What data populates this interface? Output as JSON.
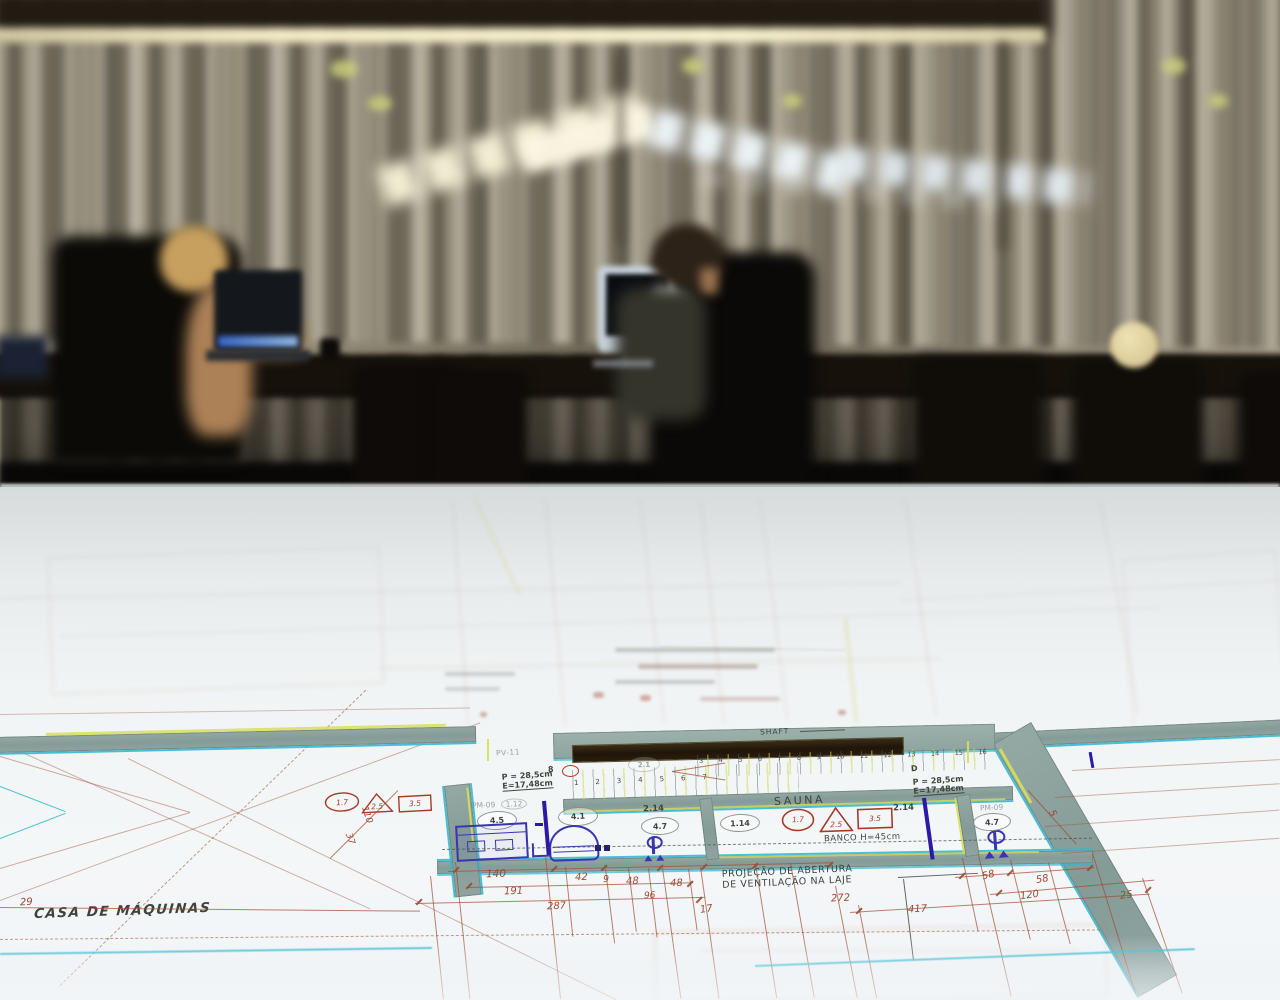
{
  "scene": {
    "type": "blurred-office-photo-background",
    "colors": {
      "wall_stripe_light": "#b7af9c",
      "wall_stripe_dark": "#6e6757",
      "ceiling": "#221b12",
      "light_strip": "#f4ecc6",
      "truss_light_warm": "#f8f2d8",
      "truss_light_cool": "#e6eff6",
      "desk": "#17120c",
      "chair": "#0d0a07",
      "hair_blonde": "#c79f5e",
      "hair_brown": "#2c2217",
      "skin": "#ad8157",
      "tshirt": "#34342b",
      "monitor_frame": "#c9d4de",
      "screen_dark": "#0b0e11",
      "laptop_glow": "#4a78cc",
      "sphere": "#e9daa9"
    }
  },
  "blueprint": {
    "colors": {
      "paper": "#f1f5f6",
      "wall_fill": "#8ba29e",
      "accent_cyan": "#35b8d0",
      "accent_yellow": "#d9de5a",
      "dim_red": "#9a4a31",
      "ink": "#3f463e",
      "fixture_blue": "#3a35b0",
      "symbol_red": "#a83a28",
      "shaft_dark": "#251a0e"
    },
    "labels": {
      "shaft": "SHAFT",
      "sauna": "SAUNA",
      "banco": "BANCO H=45cm",
      "projecao_line1": "PROJEÇÃO DE ABERTURA",
      "projecao_line2": "DE VENTILAÇÃO NA LAJE",
      "casa_maquinas": "CASA DE MÁQUINAS",
      "stair_spec_p": "P = 28,5cm",
      "stair_spec_e": "E=17,48cm",
      "pv11": "PV-11",
      "pm09_left": "PM-09",
      "pm09_left_ref": "1.12",
      "pm09_right": "PM-09",
      "d_mark": "D",
      "mark_8": "8",
      "hex_2_1": "2.1"
    },
    "rooms": {
      "r45": "4.5",
      "r41": "4.1",
      "r214a": "2.14",
      "r47a": "4.7",
      "r114": "1.14",
      "r214b": "2.14",
      "r47b": "4.7"
    },
    "symbols": {
      "circle": "1.7",
      "triangle": "2.5",
      "square": "3.5"
    },
    "stairs_lower": [
      "1",
      "2",
      "3",
      "4",
      "5",
      "6",
      "7"
    ],
    "stairs_upper": [
      "3",
      "4",
      "5",
      "6",
      "7",
      "8",
      "9",
      "10",
      "11",
      "12",
      "13",
      "14",
      "15",
      "16"
    ],
    "dims": {
      "d140": "140",
      "d191": "191",
      "d287": "287",
      "d29": "29",
      "d42": "42",
      "d9": "9",
      "d48a": "48",
      "d48b": "48",
      "d96": "96",
      "d17": "17",
      "d272": "272",
      "d417": "417",
      "d58a": "58",
      "d58b": "58",
      "d120": "120",
      "d25": "25",
      "d110": "110",
      "d37": "37",
      "d5": "5"
    }
  }
}
